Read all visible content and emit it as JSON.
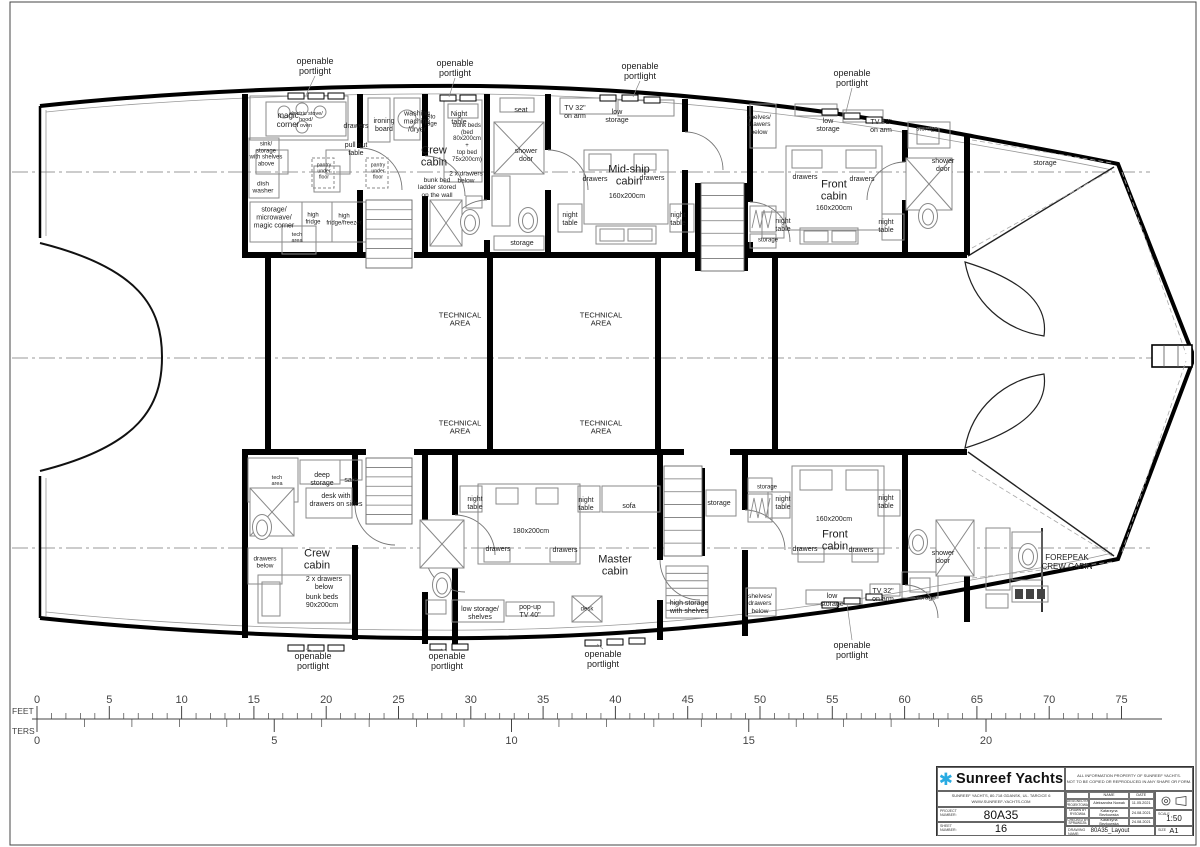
{
  "titleblock": {
    "logo_star_glyph": "✱",
    "company": "Sunreef Yachts",
    "notice": "ALL INFORMATION PROPERTY OF SUNREEF YACHTS.\nNOT TO BE COPIED OR REPRODUCED IN ANY SHAPE OR FORM.",
    "address": "SUNREEF YACHTS, 80-718 GDANSK, UL. TARCICE 6\nWWW.SUNREEF-YACHTS.COM",
    "project_label": "PROJECT\nNUMBER:",
    "project_value": "80A35",
    "sheet_label": "SHEET\nNUMBER:",
    "sheet_value": "16",
    "name_header": "NAME",
    "date_header": "DATE",
    "rows": [
      {
        "role": "DESIGNED BY\nPROJEKTOWAŁ",
        "name": "Aleksandra Nowak",
        "date": "11.05.2021"
      },
      {
        "role": "DRAWN BY\nRYSOWAŁ",
        "name": "Katarzyna Bezkowska",
        "date": "24.08.2021"
      },
      {
        "role": "CHECKED BY\nSPRAWDZIŁ",
        "name": "Katarzyna Bezkowska",
        "date": "24.08.2021"
      }
    ],
    "drawing_label": "DRAWING\nNAME:",
    "drawing_value": "80A35_Layout",
    "scale_label": "SCALE",
    "scale_value": "1:50",
    "size_label": "SIZE",
    "size_value": "A1"
  },
  "rulers": {
    "feet": {
      "label": "FEET",
      "numbers": [
        0,
        5,
        10,
        15,
        20,
        25,
        30,
        35,
        40,
        45,
        50,
        55,
        60,
        65,
        70,
        75
      ]
    },
    "meters": {
      "label": "TERS",
      "numbers": [
        0,
        5,
        10,
        15,
        20
      ]
    }
  },
  "plan": {
    "labels": [
      {
        "t": "openable\nportlight",
        "x": 315,
        "y": 66,
        "fs": 9
      },
      {
        "t": "openable\nportlight",
        "x": 455,
        "y": 68,
        "fs": 9
      },
      {
        "t": "openable\nportlight",
        "x": 640,
        "y": 71,
        "fs": 9
      },
      {
        "t": "openable\nportlight",
        "x": 852,
        "y": 78,
        "fs": 9
      },
      {
        "t": "openable\nportlight",
        "x": 313,
        "y": 661,
        "fs": 9
      },
      {
        "t": "openable\nportlight",
        "x": 447,
        "y": 661,
        "fs": 9
      },
      {
        "t": "openable\nportlight",
        "x": 603,
        "y": 659,
        "fs": 9
      },
      {
        "t": "openable\nportlight",
        "x": 852,
        "y": 650,
        "fs": 9
      },
      {
        "t": "magic\ncorner",
        "x": 288,
        "y": 121,
        "fs": 8
      },
      {
        "t": "electric stove/\nhood/\noven",
        "x": 306,
        "y": 120,
        "fs": 5.5
      },
      {
        "t": "drawers",
        "x": 356,
        "y": 127,
        "fs": 7
      },
      {
        "t": "ironing\nboard",
        "x": 384,
        "y": 126,
        "fs": 7
      },
      {
        "t": "washing\nmachine\n/dryer",
        "x": 417,
        "y": 122,
        "fs": 7
      },
      {
        "t": "Sto\nrage",
        "x": 431,
        "y": 121,
        "fs": 6
      },
      {
        "t": "Night\ntable",
        "x": 459,
        "y": 119,
        "fs": 7
      },
      {
        "t": "bunk beds\n(bed\n80x200cm\n+\ntop bed\n75x200cm)",
        "x": 467,
        "y": 143,
        "fs": 6
      },
      {
        "t": "2 x drawers\nbelow",
        "x": 466,
        "y": 178,
        "fs": 6.5
      },
      {
        "t": "Crew\ncabin",
        "x": 434,
        "y": 157,
        "fs": 11
      },
      {
        "t": "bunk bed\nladder stored\non the wall",
        "x": 437,
        "y": 188,
        "fs": 6.5
      },
      {
        "t": "sink/\nstorage\nwith shelves\nabove",
        "x": 266,
        "y": 155,
        "fs": 6
      },
      {
        "t": "dish\nwasher",
        "x": 263,
        "y": 188,
        "fs": 6.5
      },
      {
        "t": "pull out\ntable",
        "x": 356,
        "y": 150,
        "fs": 7
      },
      {
        "t": "pantry\nunder\nfloor",
        "x": 324,
        "y": 172,
        "fs": 5.2
      },
      {
        "t": "pantry\nunder\nfloor",
        "x": 378,
        "y": 172,
        "fs": 5.2
      },
      {
        "t": "storage/\nmicrowave/\nmagic corner",
        "x": 274,
        "y": 218,
        "fs": 7
      },
      {
        "t": "high\nfridge",
        "x": 313,
        "y": 219,
        "fs": 6
      },
      {
        "t": "high\nfridge/freezer",
        "x": 344,
        "y": 220,
        "fs": 6
      },
      {
        "t": "tech\narea",
        "x": 297,
        "y": 238,
        "fs": 5.5
      },
      {
        "t": "seat",
        "x": 521,
        "y": 111,
        "fs": 7
      },
      {
        "t": "shower\ndoor",
        "x": 526,
        "y": 156,
        "fs": 7
      },
      {
        "t": "storage",
        "x": 522,
        "y": 244,
        "fs": 7
      },
      {
        "t": "TV 32\"\non arm",
        "x": 575,
        "y": 113,
        "fs": 7
      },
      {
        "t": "low\nstorage",
        "x": 617,
        "y": 117,
        "fs": 7
      },
      {
        "t": "night\ntable",
        "x": 570,
        "y": 220,
        "fs": 7
      },
      {
        "t": "night\ntable",
        "x": 678,
        "y": 220,
        "fs": 7
      },
      {
        "t": "Mid-ship\ncabin",
        "x": 629,
        "y": 176,
        "fs": 11
      },
      {
        "t": "drawers",
        "x": 595,
        "y": 180,
        "fs": 7
      },
      {
        "t": "drawers",
        "x": 652,
        "y": 179,
        "fs": 7
      },
      {
        "t": "160x200cm",
        "x": 627,
        "y": 197,
        "fs": 7
      },
      {
        "t": "shelves/\ndrawers\nbelow",
        "x": 759,
        "y": 125,
        "fs": 6.5
      },
      {
        "t": "low\nstorage",
        "x": 828,
        "y": 126,
        "fs": 7
      },
      {
        "t": "TV 32\"\non arm",
        "x": 881,
        "y": 127,
        "fs": 7
      },
      {
        "t": "storage",
        "x": 927,
        "y": 129,
        "fs": 6.5
      },
      {
        "t": "shower\ndoor",
        "x": 943,
        "y": 166,
        "fs": 7
      },
      {
        "t": "Front\ncabin",
        "x": 834,
        "y": 191,
        "fs": 11
      },
      {
        "t": "drawers",
        "x": 805,
        "y": 178,
        "fs": 7
      },
      {
        "t": "drawers",
        "x": 862,
        "y": 180,
        "fs": 7
      },
      {
        "t": "160x200cm",
        "x": 834,
        "y": 209,
        "fs": 7
      },
      {
        "t": "night\ntable",
        "x": 783,
        "y": 226,
        "fs": 7
      },
      {
        "t": "night\ntable",
        "x": 886,
        "y": 227,
        "fs": 7
      },
      {
        "t": "storage",
        "x": 768,
        "y": 241,
        "fs": 6
      },
      {
        "t": "storage",
        "x": 1045,
        "y": 164,
        "fs": 7
      },
      {
        "t": "TECHNICAL\nAREA",
        "x": 460,
        "y": 320,
        "fs": 7.5
      },
      {
        "t": "TECHNICAL\nAREA",
        "x": 601,
        "y": 320,
        "fs": 7.5
      },
      {
        "t": "TECHNICAL\nAREA",
        "x": 460,
        "y": 428,
        "fs": 7.5
      },
      {
        "t": "TECHNICAL\nAREA",
        "x": 601,
        "y": 428,
        "fs": 7.5
      },
      {
        "t": "tech\narea",
        "x": 277,
        "y": 481,
        "fs": 5.5
      },
      {
        "t": "deep\nstorage",
        "x": 322,
        "y": 480,
        "fs": 7
      },
      {
        "t": "safe",
        "x": 351,
        "y": 481,
        "fs": 7
      },
      {
        "t": "desk with\ndrawers on sides",
        "x": 336,
        "y": 501,
        "fs": 7
      },
      {
        "t": "drawers\nbelow",
        "x": 265,
        "y": 563,
        "fs": 6.5
      },
      {
        "t": "Crew\ncabin",
        "x": 317,
        "y": 560,
        "fs": 11
      },
      {
        "t": "2 x drawers\nbelow",
        "x": 324,
        "y": 584,
        "fs": 7
      },
      {
        "t": "bunk beds\n90x200cm",
        "x": 322,
        "y": 602,
        "fs": 7
      },
      {
        "t": "night\ntable",
        "x": 475,
        "y": 504,
        "fs": 7
      },
      {
        "t": "night\ntable",
        "x": 586,
        "y": 505,
        "fs": 7
      },
      {
        "t": "sofa",
        "x": 629,
        "y": 507,
        "fs": 7
      },
      {
        "t": "180x200cm",
        "x": 531,
        "y": 532,
        "fs": 7
      },
      {
        "t": "drawers",
        "x": 498,
        "y": 550,
        "fs": 7
      },
      {
        "t": "drawers",
        "x": 565,
        "y": 551,
        "fs": 7
      },
      {
        "t": "Master\ncabin",
        "x": 615,
        "y": 566,
        "fs": 11
      },
      {
        "t": "low storage/\nshelves",
        "x": 480,
        "y": 614,
        "fs": 7
      },
      {
        "t": "pop-up\nTV 40\"",
        "x": 530,
        "y": 612,
        "fs": 7
      },
      {
        "t": "desk",
        "x": 587,
        "y": 610,
        "fs": 6
      },
      {
        "t": "high storage\nwith shelves",
        "x": 689,
        "y": 608,
        "fs": 7
      },
      {
        "t": "storage",
        "x": 719,
        "y": 504,
        "fs": 7
      },
      {
        "t": "storage",
        "x": 767,
        "y": 488,
        "fs": 6
      },
      {
        "t": "night\ntable",
        "x": 783,
        "y": 504,
        "fs": 7
      },
      {
        "t": "night\ntable",
        "x": 886,
        "y": 503,
        "fs": 7
      },
      {
        "t": "160x200cm",
        "x": 834,
        "y": 520,
        "fs": 7
      },
      {
        "t": "Front\ncabin",
        "x": 835,
        "y": 541,
        "fs": 11
      },
      {
        "t": "drawers",
        "x": 805,
        "y": 550,
        "fs": 7
      },
      {
        "t": "drawers",
        "x": 861,
        "y": 551,
        "fs": 7
      },
      {
        "t": "shelves/\ndrawers\nbelow",
        "x": 760,
        "y": 604,
        "fs": 6.5
      },
      {
        "t": "low\nstorage",
        "x": 832,
        "y": 601,
        "fs": 7
      },
      {
        "t": "TV 32\"\non arm",
        "x": 883,
        "y": 596,
        "fs": 7
      },
      {
        "t": "storage",
        "x": 925,
        "y": 598,
        "fs": 6.5
      },
      {
        "t": "shower\ndoor",
        "x": 943,
        "y": 558,
        "fs": 7
      },
      {
        "t": "FOREPEAK\nCREW CABIN",
        "x": 1067,
        "y": 563,
        "fs": 8
      }
    ]
  }
}
